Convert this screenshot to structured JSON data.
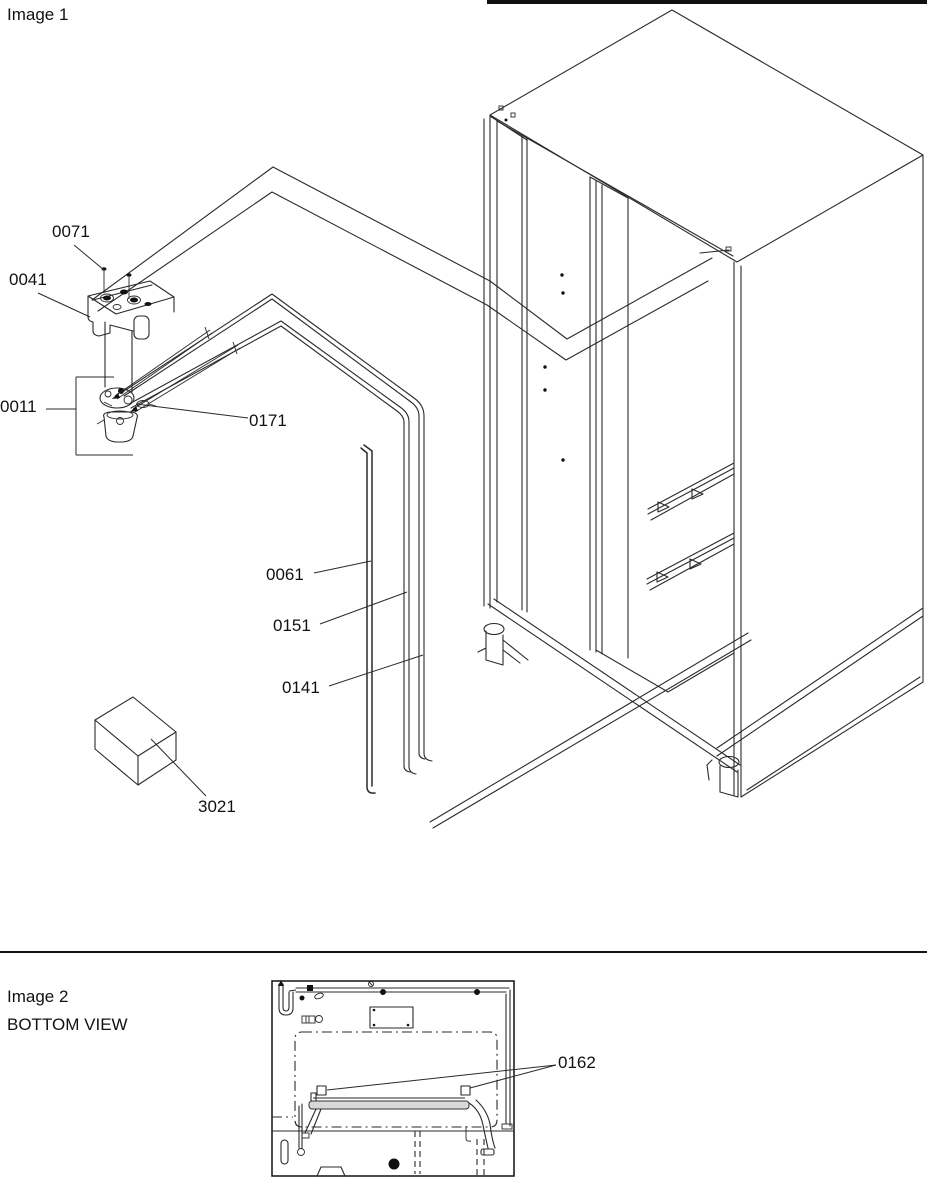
{
  "colors": {
    "line": "#2a2a2a",
    "background": "#ffffff",
    "rail_gray": "#d8d8d8",
    "text": "#111111"
  },
  "image1": {
    "title": "Image 1",
    "part_labels": [
      {
        "id": "0071"
      },
      {
        "id": "0041"
      },
      {
        "id": "0011"
      },
      {
        "id": "0171"
      },
      {
        "id": "0061"
      },
      {
        "id": "0151"
      },
      {
        "id": "0141"
      },
      {
        "id": "3021"
      }
    ]
  },
  "image2": {
    "title": "Image 2",
    "view_label": "BOTTOM VIEW",
    "part_labels": [
      {
        "id": "0162"
      }
    ]
  }
}
